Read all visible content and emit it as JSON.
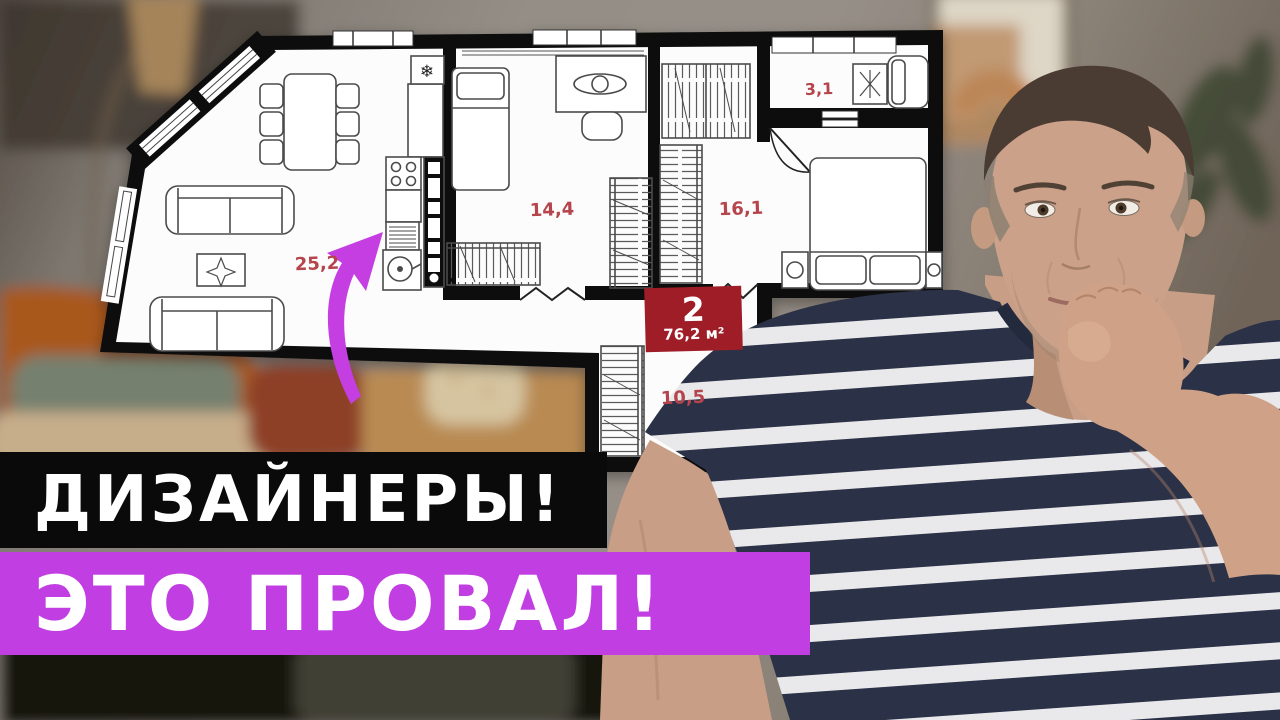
{
  "banner": {
    "line1": "ДИЗАЙНЕРЫ!",
    "line2": "ЭТО ПРОВАЛ!"
  },
  "floor_plan": {
    "room_labels": [
      "25,2",
      "14,4",
      "16,1",
      "3,1",
      "10,5"
    ],
    "badge": {
      "rooms": "2",
      "area": "76,2 м²"
    },
    "vent_symbol": "❄"
  },
  "colors": {
    "banner_black": "#0a0a0a",
    "banner_magenta": "#c13fe2",
    "badge_red": "#9e1d27",
    "room_label_red": "#b5444c",
    "arrow_magenta": "#c43ee2"
  }
}
